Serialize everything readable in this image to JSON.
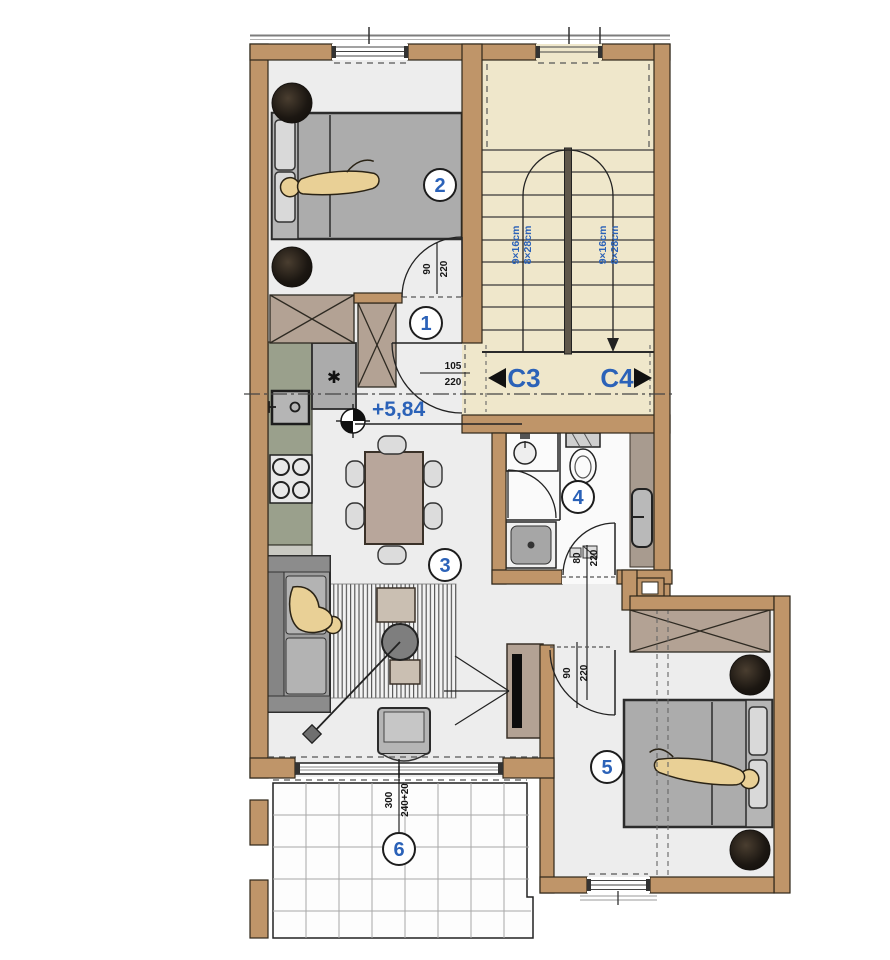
{
  "floor_plan": {
    "room_markers": [
      "1",
      "2",
      "3",
      "4",
      "5",
      "6"
    ],
    "section_markers": {
      "left": {
        "label": "C3"
      },
      "right": {
        "label": "C4"
      }
    },
    "elevation_marker": {
      "label": "+5,84"
    },
    "stairs": {
      "flight_labels": [
        "9×16cm",
        "8×28cm"
      ]
    },
    "doors": {
      "bedroom2": {
        "width": "90",
        "height": "220"
      },
      "entry": {
        "width": "105",
        "height": "220"
      },
      "bathroom": {
        "width": "80",
        "height": "220"
      },
      "bedroom5": {
        "width": "90",
        "height": "220"
      }
    },
    "balcony": {
      "dim_a": "300",
      "dim_b": "240+20"
    },
    "kitchen": {
      "appliance_symbol": "✱"
    },
    "colors": {
      "wall": "#bf9569",
      "stair_floor": "#efe7cb",
      "room_floor": "#ededed",
      "bath_floor": "#fafafa",
      "furniture_taupe": "#b3a294",
      "kitchen_counter": "#9aa08c",
      "accent_blue": "#2b62b8",
      "dark_circle": "#241d17",
      "person": "#e9d096"
    }
  }
}
